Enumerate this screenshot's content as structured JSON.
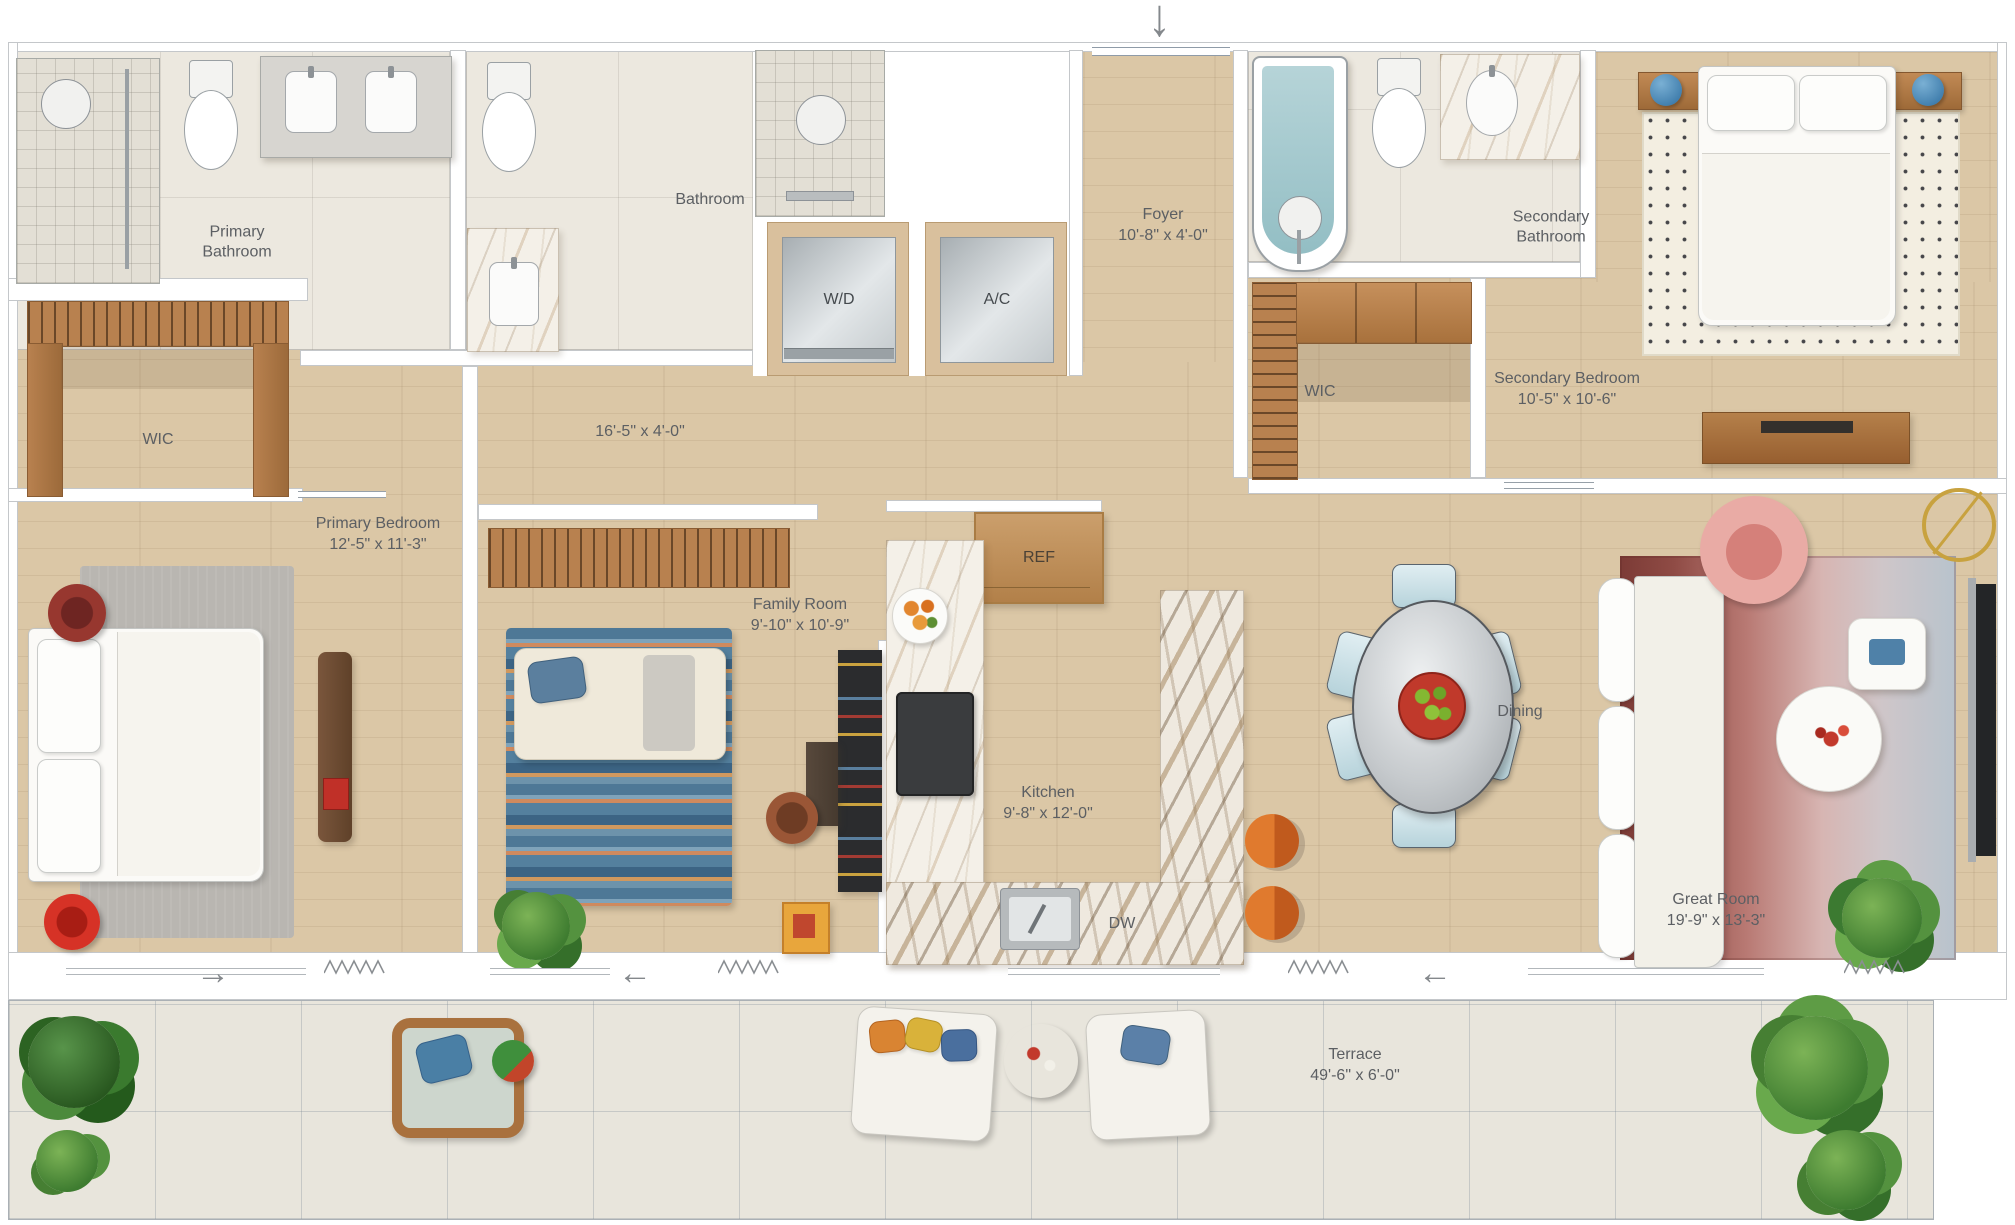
{
  "rooms": {
    "primary_bathroom": {
      "name": "Primary Bathroom",
      "dims": ""
    },
    "bathroom": {
      "name": "Bathroom",
      "dims": ""
    },
    "wd_closet": {
      "name": "W/D"
    },
    "ac_closet": {
      "name": "A/C"
    },
    "foyer": {
      "name": "Foyer",
      "dims": "10'-8\" x 4'-0\""
    },
    "secondary_bathroom": {
      "name": "Secondary Bathroom",
      "dims": ""
    },
    "wic_left": {
      "name": "WIC"
    },
    "wic_right": {
      "name": "WIC"
    },
    "secondary_bedroom": {
      "name": "Secondary Bedroom",
      "dims": "10'-5\" x 10'-6\""
    },
    "hallway": {
      "name": "",
      "dims": "16'-5\" x 4'-0\""
    },
    "primary_bedroom": {
      "name": "Primary Bedroom",
      "dims": "12'-5\" x 11'-3\""
    },
    "family_room": {
      "name": "Family Room",
      "dims": "9'-10\" x 10'-9\""
    },
    "kitchen": {
      "name": "Kitchen",
      "dims": "9'-8\" x 12'-0\""
    },
    "dining": {
      "name": "Dining"
    },
    "great_room": {
      "name": "Great Room",
      "dims": "19'-9\" x 13'-3\""
    },
    "terrace": {
      "name": "Terrace",
      "dims": "49'-6\" x 6'-0\""
    }
  },
  "appliances": {
    "refrigerator": "REF",
    "dishwasher": "DW"
  },
  "icons": {
    "entry_arrow": "↓",
    "slide_left": "←",
    "slide_right": "→"
  },
  "colors": {
    "wood_floor": "#dbc7a6",
    "bath_tile": "#ece8df",
    "terrace_tile": "#e8e5dc",
    "wall": "#ffffff",
    "wall_line": "#969ba0",
    "label_text": "#5c5f63",
    "tub": "#a9cbd0",
    "marble_vein": "#b08e60",
    "rug_blue": "#4e7896",
    "rug_orange": "#cf8a5e",
    "rug_gradient_left": "#7c3b36",
    "rug_gradient_right": "#b8c3cc",
    "stool_orange": "#dd7630",
    "accent_red": "#d1342c",
    "chair_blue": "#cfe2e8",
    "plant_green": "#4e9040",
    "closet_wood": "#b8814f",
    "armchair_pink": "#e9aba5"
  }
}
